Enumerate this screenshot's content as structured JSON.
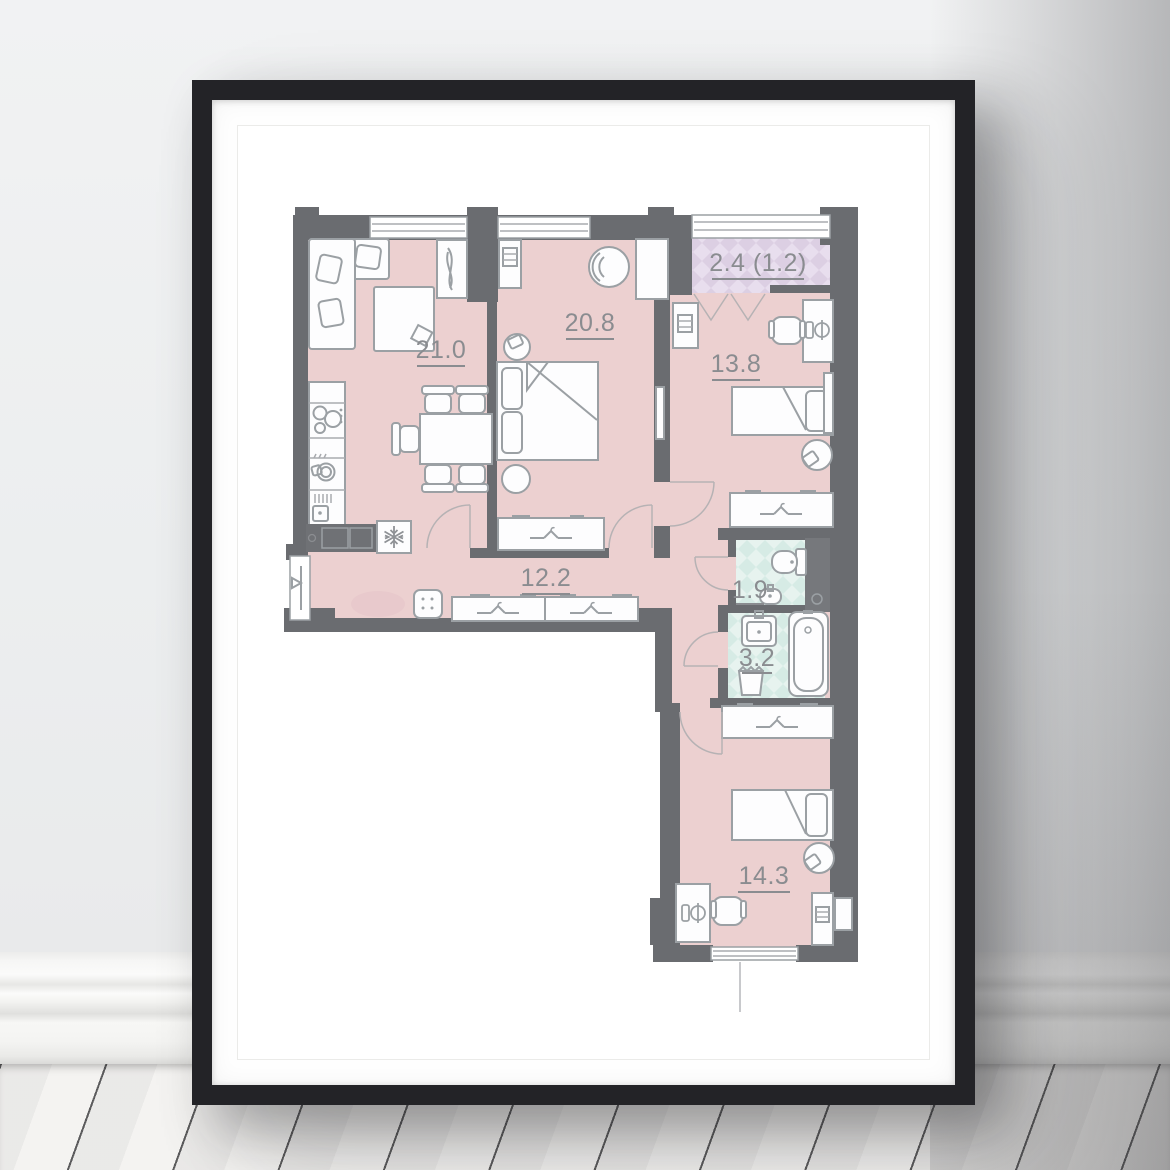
{
  "scene": {
    "description": "black picture frame with white mat leaning on wall above white wooden plank floor",
    "colors": {
      "wall": "#eef0f1",
      "frame": "#232327",
      "mat": "#fefefe",
      "floor": "#f3f2f0"
    }
  },
  "floor_plan": {
    "rooms": [
      {
        "name": "living-kitchen",
        "area": "21.0"
      },
      {
        "name": "bedroom-master",
        "area": "20.8"
      },
      {
        "name": "bedroom-child",
        "area": "13.8"
      },
      {
        "name": "balcony",
        "area": "2.4 (1.2)"
      },
      {
        "name": "hallway",
        "area": "12.2"
      },
      {
        "name": "wc",
        "area": "1.9"
      },
      {
        "name": "bathroom",
        "area": "3.2"
      },
      {
        "name": "bedroom-bottom",
        "area": "14.3"
      }
    ],
    "colors": {
      "room_fill": "#ecd0d0",
      "wet_room_fill": "#d6ebe5",
      "wet_room_fill_alt": "#e7f3ef",
      "balcony_fill": "#dccfe3",
      "balcony_fill_alt": "#e8deee",
      "walls": "#6a6c70",
      "furniture_stroke": "#9ba0a4",
      "labels": "#8a8c90"
    }
  }
}
